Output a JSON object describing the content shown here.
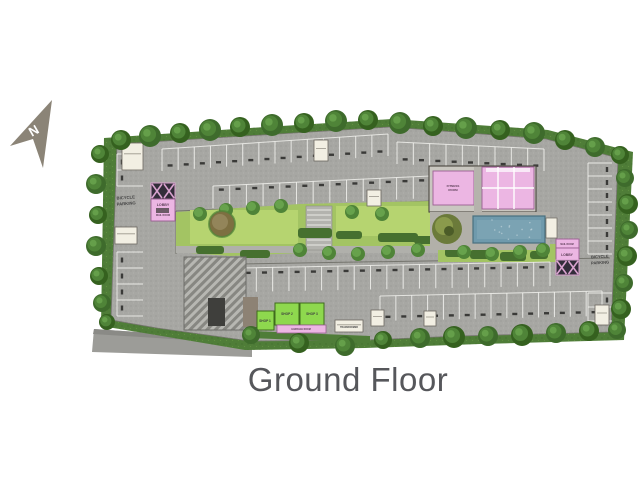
{
  "title": "Ground Floor",
  "compass": {
    "label": "N"
  },
  "plan": {
    "labels": {
      "bicycle_left_1": "BICYCLE",
      "bicycle_left_2": "PARKING",
      "lobby_left": "LOBBY",
      "mail_left": "MAIL ROOM",
      "bicycle_right_1": "BICYCLE",
      "bicycle_right_2": "PARKING",
      "lobby_right": "LOBBY",
      "mail_right": "MAIL ROOM",
      "fitness_1": "FITNESS",
      "fitness_2": "ROOM",
      "shop1": "SHOP 1",
      "shop2": "SHOP 2",
      "shop3": "SHOP 3",
      "garbage": "GARBAGE ROOM",
      "transformer": "TRANSFORMER"
    }
  },
  "colors": {
    "concrete": "#a7a7a3",
    "green_edge": "#4f7d38",
    "tree": "#3e6b2c",
    "tree_mid": "#4f8438",
    "tree_light": "#67a24c",
    "lawn": "#a3c463",
    "lawn_bright": "#b6d470",
    "bush": "#46702f",
    "pink_room": "#ecb6e3",
    "pink_border": "#9a5f91",
    "shop_green": "#8ed84e",
    "shop_border": "#3f6b1c",
    "pool": "#6f9aac",
    "pool_light": "#85abba",
    "pool_border": "#49707f",
    "cream_room": "#f2efe3",
    "wall": "#4a463f",
    "stair_dark": "#332d3a",
    "stair_pink": "#d9a2cf",
    "ramp_dark": "#3f3f3c",
    "road": "#9c9c98",
    "deck": "#b2b0a9",
    "arrow": "#8b8477",
    "title": "#56575b",
    "stall_line": "#f4f4f0",
    "wheel_stop": "#3a3a38",
    "edge_line": "#75756e"
  }
}
